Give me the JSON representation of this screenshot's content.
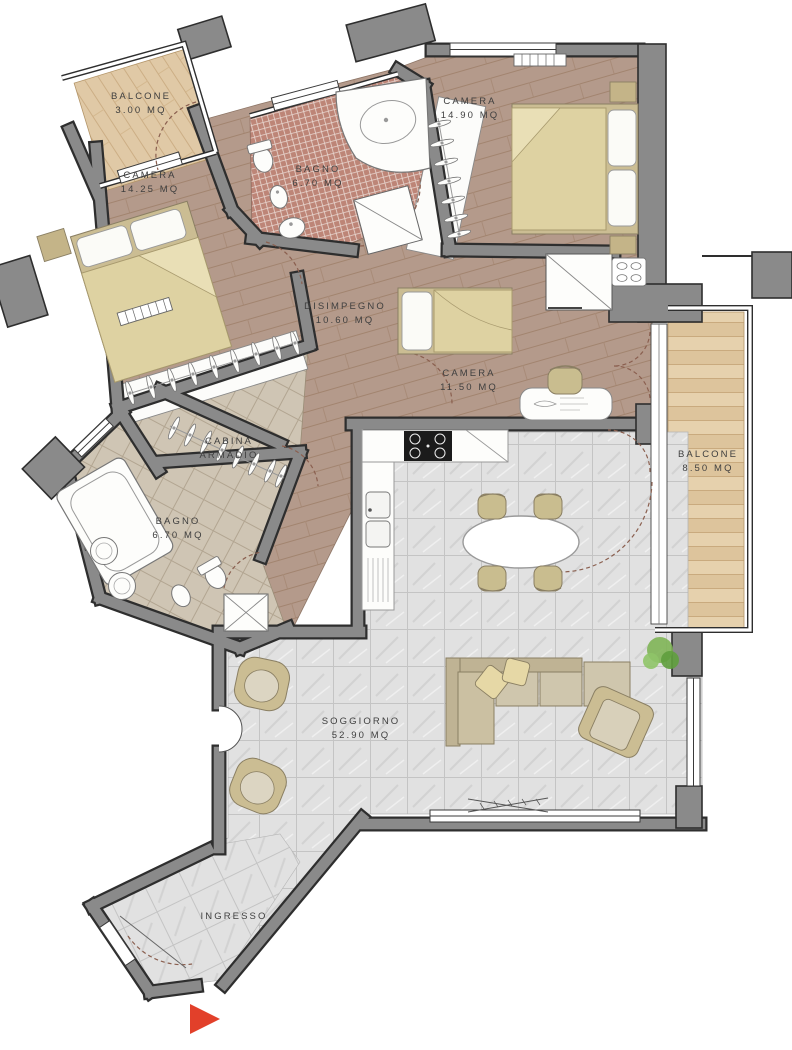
{
  "plan": {
    "type": "apartment-floor-plan",
    "rooms": [
      {
        "id": "balcone-3",
        "name": "BALCONE",
        "area": "3.00 MQ"
      },
      {
        "id": "camera-1",
        "name": "CAMERA",
        "area": "14.25 MQ"
      },
      {
        "id": "bagno-1",
        "name": "BAGNO",
        "area": "6.70 MQ"
      },
      {
        "id": "camera-2",
        "name": "CAMERA",
        "area": "14.90 MQ"
      },
      {
        "id": "disimpegno",
        "name": "DISIMPEGNO",
        "area": "10.60 MQ"
      },
      {
        "id": "camera-3",
        "name": "CAMERA",
        "area": "11.50 MQ"
      },
      {
        "id": "balcone-85",
        "name": "BALCONE",
        "area": "8.50 MQ"
      },
      {
        "id": "cabina",
        "name": "CABINA",
        "area": "ARMADIO"
      },
      {
        "id": "bagno-2",
        "name": "BAGNO",
        "area": "6.70 MQ"
      },
      {
        "id": "soggiorno",
        "name": "SOGGIORNO",
        "area": "52.90 MQ"
      },
      {
        "id": "ingresso",
        "name": "INGRESSO",
        "area": ""
      }
    ],
    "icons": [
      "double-bed",
      "single-bed",
      "corner-bathtub",
      "bathtub",
      "shower",
      "toilet",
      "bidet",
      "washbasin",
      "coat-hangers",
      "kitchen-hob",
      "kitchen-sink",
      "dining-table",
      "chair",
      "sofa",
      "armchair",
      "pouf",
      "plant",
      "desk",
      "shoe-rack",
      "radiator",
      "door-swing",
      "entrance-arrow"
    ],
    "colors": {
      "wall": "#8a8a8a",
      "wall_outline": "#2e2e2e",
      "wood_dark": "#b49a8b",
      "wood_light": "#e2cba4",
      "marble": "#e2e2e2",
      "mosaic_pink": "#bd8577",
      "tile_beige": "#cfc5b4",
      "furniture_beige": "#cdbf96",
      "duvet": "#ded2a2",
      "entrance_arrow_red": "#e2402a",
      "label_text": "#3f3f3f"
    }
  }
}
